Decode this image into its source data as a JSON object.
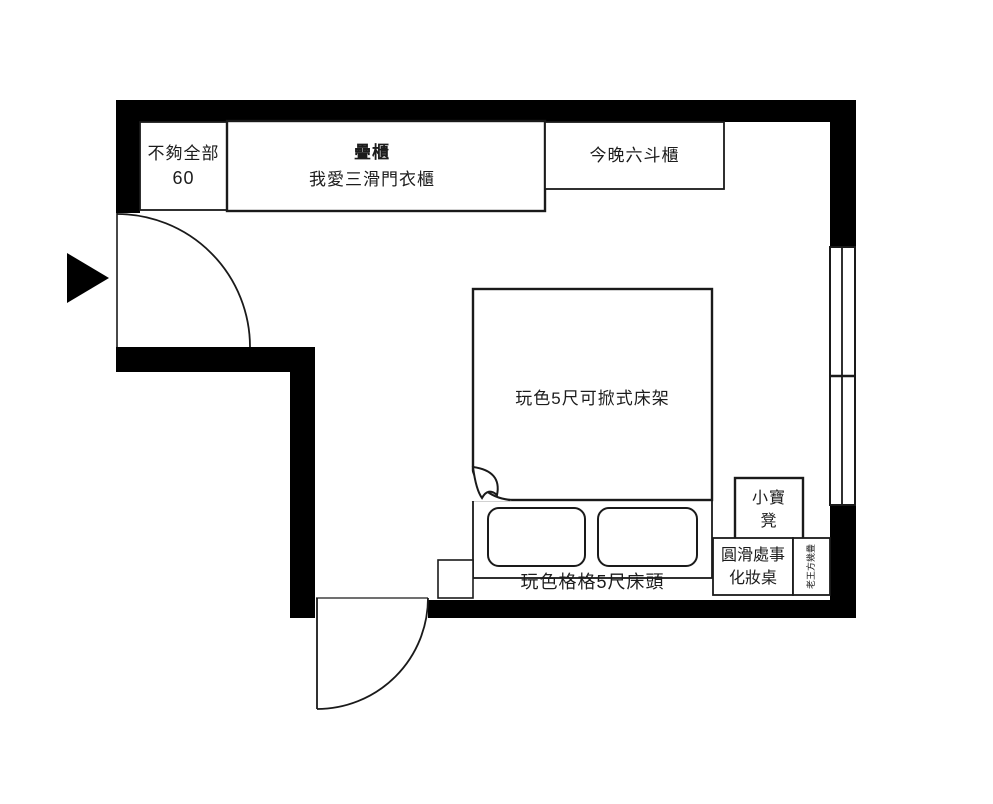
{
  "meta": {
    "title": "bedroom floor plan",
    "description": "black-and-white furniture layout floor plan with one entry door, one bottom swing door and a window wall on the right"
  },
  "colors": {
    "wall": "#000000",
    "line": "#1a1a1a",
    "background": "#ffffff",
    "text": "#1c1c1c"
  },
  "furniture": {
    "closet_small": {
      "lines": [
        "不夠全部",
        "60"
      ]
    },
    "wardrobe": {
      "lines": [
        "疊櫃",
        "我愛三滑門衣櫃"
      ]
    },
    "dresser": {
      "label": "今晚六斗櫃"
    },
    "bed": {
      "label": "玩色5尺可掀式床架"
    },
    "headboard": {
      "label": "玩色格格5尺床頭"
    },
    "stool": {
      "lines": [
        "小寶",
        "凳"
      ]
    },
    "vanity": {
      "lines": [
        "圓滑處事",
        "化妝桌"
      ]
    },
    "side_table": {
      "label": "老王方幾疊"
    }
  },
  "symbols": {
    "entry_arrow": "entrance direction triangle",
    "left_door": "left swing door",
    "bottom_door": "bottom swing door",
    "window": "right wall double-pane window"
  }
}
